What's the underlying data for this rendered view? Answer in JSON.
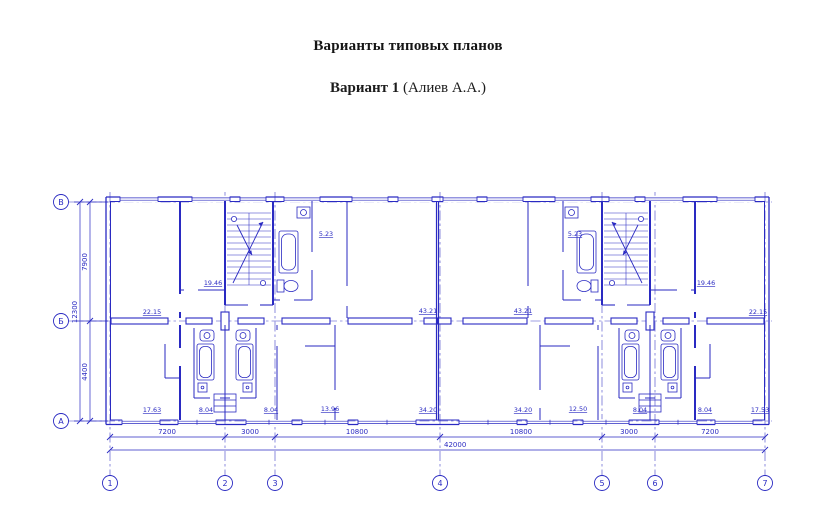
{
  "page": {
    "title": "Варианты типовых планов",
    "subtitle_bold": "Вариант 1",
    "subtitle_rest": " (Алиев А.А.)"
  },
  "plan": {
    "ink_color": "#2a2ac2",
    "axes": {
      "letters": [
        "В",
        "Б",
        "А"
      ],
      "numbers": [
        "1",
        "2",
        "3",
        "4",
        "5",
        "6",
        "7"
      ]
    },
    "dims": {
      "v_top": "7900",
      "v_bottom": "4400",
      "v_total": "12300",
      "h_segments": [
        "7200",
        "3000",
        "10800",
        "10800",
        "3000",
        "7200"
      ],
      "h_total": "42000"
    },
    "rooms_upper": [
      "22.15",
      "19.46",
      "5.23",
      "43.21",
      "43.21",
      "5.23",
      "19.46",
      "22.15"
    ],
    "rooms_lower": [
      "17.63",
      "8.04",
      "8.04",
      "13.96",
      "34.20",
      "34.20",
      "12.50",
      "8.04",
      "8.04",
      "17.53"
    ],
    "icons": {
      "staircase": "staircase-with-direction-arrows",
      "bathtub": "bathtub-fixture",
      "toilet": "toilet-fixture",
      "sink": "sink-fixture"
    }
  }
}
